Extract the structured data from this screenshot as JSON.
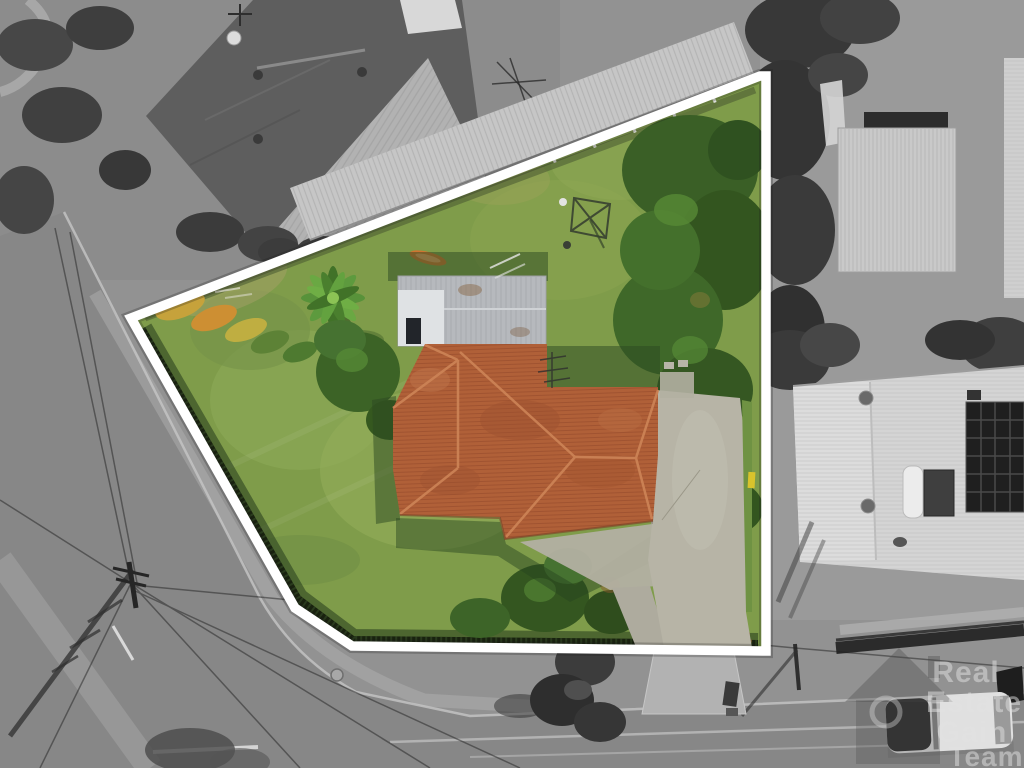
{
  "image": {
    "kind": "aerial-drone-property-photo",
    "width_px": 1024,
    "height_px": 768,
    "highlight_style": "subject parcel in full color inside a thick white boundary outline; all surroundings desaturated grayscale"
  },
  "watermark": {
    "line1": "Real",
    "line2": "Estate",
    "line3": "Gain",
    "line4": "Team",
    "logo": "house-outline-with-ring"
  },
  "palette": {
    "boundary_outline": "#ffffff",
    "lawn_green": "#7f9c4a",
    "roof_terracotta": "#b06038",
    "garage_metal": "#b6b9bd",
    "tree_green": "#3a5f26",
    "driveway_concrete": "#b7b4a6",
    "surroundings_gray": "#929292",
    "asphalt_gray": "#888888",
    "accent_yellow_shrubs": "#c6a23b"
  }
}
